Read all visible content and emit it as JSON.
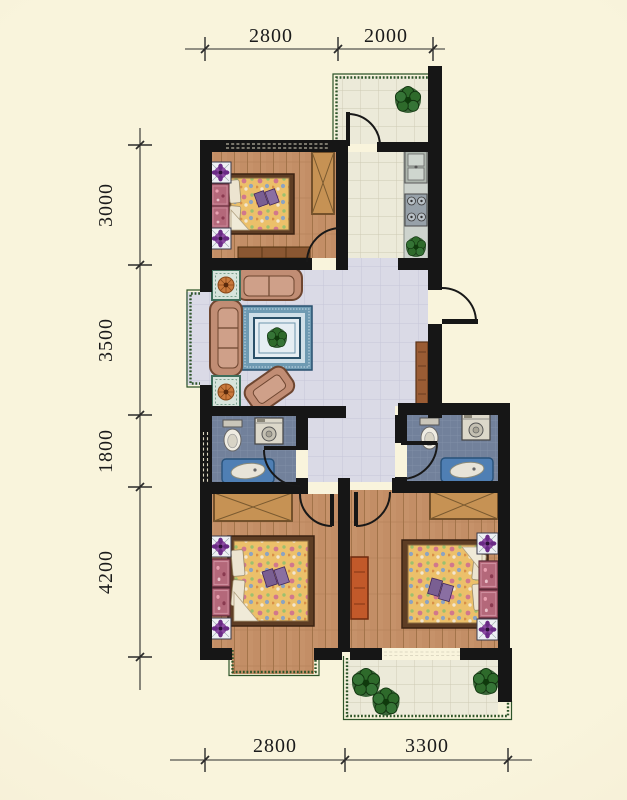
{
  "dimensions": {
    "top": [
      "2800",
      "2000"
    ],
    "left": [
      "3000",
      "3500",
      "1800",
      "4200"
    ],
    "bottom": [
      "2800",
      "3300"
    ]
  },
  "palette": {
    "background": "#f8f3d8",
    "wall": "#161616",
    "wood_floor": "#c6926a",
    "living_room_tile": "#dadae6",
    "bathroom_tile": "#72819b",
    "balcony_tile": "#ecead9",
    "balcony_border_green": "#2d5429",
    "plant_green": "#2e6a2b",
    "sofa_tan": "#c18d74",
    "rug_blue": "#6e9ab2",
    "dresser_orange": "#c2592a",
    "dimension_text": "#1b1b1b"
  },
  "icons": {
    "plant": "potted-plant-top-view",
    "flower_stand": "purple-flower-nightstand",
    "pink_cabinet": "flower-cabinet",
    "toilet": "toilet-top-view",
    "washer": "washing-machine-top-view",
    "bathtub": "bathtub-top-view",
    "sink": "double-basin-kitchen-sink",
    "stove": "four-burner-stove",
    "sofa": "sofa-top-view",
    "bed": "double-bed-top-view",
    "wardrobe": "wardrobe-cross-symbol",
    "door": "door-swing-arc"
  }
}
